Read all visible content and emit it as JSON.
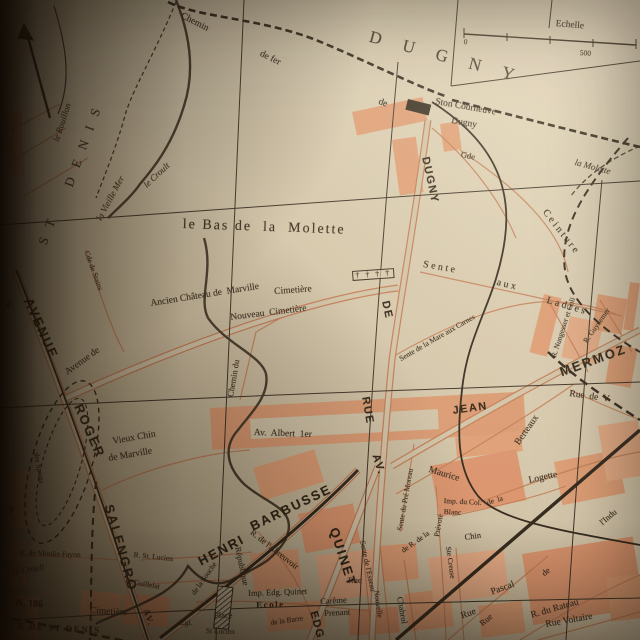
{
  "meta": {
    "kind": "vintage printed street map photographed in a book",
    "area": "Dugny / La Courneuve / St-Denis (northern Paris suburbs)"
  },
  "colors": {
    "paper_light": "#ece2ca",
    "paper_mid": "#d9cdb2",
    "paper_dark": "#b3a485",
    "building_fill": "#e7a47b",
    "road_line": "#c9805a",
    "ink": "#352b1f",
    "gutter_shadow": "#0a0603"
  },
  "scale": {
    "label": "Echelle",
    "start": "0",
    "end": "500"
  },
  "grid_refs": [
    "2",
    "3"
  ],
  "labels": [
    {
      "name": "railway-label-chemin",
      "text": "Chemin",
      "x": 183,
      "y": 12,
      "rot": 27,
      "cls": "s9"
    },
    {
      "name": "railway-label-de-fer",
      "text": "de fer",
      "x": 262,
      "y": 50,
      "rot": 26,
      "cls": "s9"
    },
    {
      "name": "railway-label-de",
      "text": "de",
      "x": 380,
      "y": 98,
      "rot": 20,
      "cls": "s9"
    },
    {
      "name": "commune-label-dugny",
      "text": "DUGNY",
      "x": 372,
      "y": 28,
      "rot": 15,
      "cls": "big"
    },
    {
      "name": "scale-label",
      "text": "Echelle",
      "x": 556,
      "y": 20,
      "rot": 5,
      "cls": "s9"
    },
    {
      "name": "scale-zero",
      "text": "0",
      "x": 464,
      "y": 38,
      "rot": 5,
      "cls": "ss"
    },
    {
      "name": "scale-500",
      "text": "500",
      "x": 580,
      "y": 49,
      "rot": 4,
      "cls": "ss"
    },
    {
      "name": "station-label-line1",
      "text": "Ston Courneuve",
      "x": 436,
      "y": 98,
      "rot": 10,
      "cls": "s9"
    },
    {
      "name": "station-label-line2",
      "text": "Dugny",
      "x": 452,
      "y": 117,
      "rot": 10,
      "cls": "s9"
    },
    {
      "name": "stream-label-la-molette",
      "text": "la Molette",
      "x": 576,
      "y": 158,
      "rot": 15,
      "cls": "it"
    },
    {
      "name": "railway-label-gde",
      "text": "Gde",
      "x": 462,
      "y": 150,
      "rot": 12,
      "cls": "s"
    },
    {
      "name": "railway-label-ceinture",
      "text": "Ceinture",
      "x": 548,
      "y": 208,
      "rot": 52,
      "cls": "sp"
    },
    {
      "name": "stream-label-le-rouillon",
      "text": "le Rouillon",
      "x": 52,
      "y": 140,
      "rot": -72,
      "cls": "it"
    },
    {
      "name": "stream-label-la-vieille-mer",
      "text": "la Vieille Mer",
      "x": 95,
      "y": 218,
      "rot": -62,
      "cls": "it"
    },
    {
      "name": "stream-label-le-croult-top",
      "text": "le Croult",
      "x": 142,
      "y": 183,
      "rot": -43,
      "cls": "it"
    },
    {
      "name": "commune-label-st",
      "text": "ST",
      "x": 36,
      "y": 242,
      "rot": -70,
      "cls": "big2"
    },
    {
      "name": "commune-label-denis",
      "text": "DENIS",
      "x": 62,
      "y": 184,
      "rot": -70,
      "cls": "big2"
    },
    {
      "name": "grid-number-2",
      "text": "2",
      "x": 6,
      "y": 300,
      "rot": 0,
      "cls": "num"
    },
    {
      "name": "grid-number-3",
      "text": "3",
      "x": 8,
      "y": 506,
      "rot": 0,
      "cls": "num"
    },
    {
      "name": "place-label-bas-de-la-molette",
      "text": "le Bas de  la  Molette",
      "x": 183,
      "y": 218,
      "rot": 2,
      "cls": "place"
    },
    {
      "name": "street-label-avenue-de",
      "text": "Avenue de",
      "x": 64,
      "y": 370,
      "rot": -36,
      "cls": "s9"
    },
    {
      "name": "street-label-ancien-chateau",
      "text": "Ancien Château de  Marville",
      "x": 150,
      "y": 300,
      "rot": -9,
      "cls": "s9"
    },
    {
      "name": "label-cimetiere",
      "text": "Cimetière",
      "x": 274,
      "y": 288,
      "rot": -4,
      "cls": "s9"
    },
    {
      "name": "cemetery-symbol",
      "text": "† † † †",
      "x": 352,
      "y": 271,
      "rot": -4,
      "cls": "cem"
    },
    {
      "name": "label-nouveau-cimetiere",
      "text": "Nouveau  Cimetière",
      "x": 230,
      "y": 314,
      "rot": -7,
      "cls": "s9"
    },
    {
      "name": "street-label-chemin-du",
      "text": "Chemin du",
      "x": 226,
      "y": 396,
      "rot": -80,
      "cls": "s"
    },
    {
      "name": "street-label-cde-de-stains",
      "text": "Cde de Stains",
      "x": 90,
      "y": 250,
      "rot": 70,
      "cls": "ss"
    },
    {
      "name": "street-label-sente",
      "text": "Sente",
      "x": 424,
      "y": 260,
      "rot": 10,
      "cls": "sp"
    },
    {
      "name": "street-label-aux",
      "text": "aux",
      "x": 498,
      "y": 278,
      "rot": 14,
      "cls": "sp"
    },
    {
      "name": "street-label-ladres",
      "text": "Ladres",
      "x": 548,
      "y": 296,
      "rot": 16,
      "cls": "sp"
    },
    {
      "name": "street-label-mare-aux-carnes",
      "text": "Sente de la Mare aux Carnes",
      "x": 398,
      "y": 356,
      "rot": -30,
      "cls": "ss"
    },
    {
      "name": "street-label-dugny-vertical",
      "text": "DUGNY",
      "x": 430,
      "y": 156,
      "rot": 78,
      "cls": "b"
    },
    {
      "name": "street-label-de-vertical",
      "text": "DE",
      "x": 390,
      "y": 300,
      "rot": 78,
      "cls": "b"
    },
    {
      "name": "street-label-rue-vertical",
      "text": "RUE",
      "x": 370,
      "y": 396,
      "rot": 80,
      "cls": "b"
    },
    {
      "name": "street-label-avenue",
      "text": "AVENUE",
      "x": 34,
      "y": 296,
      "rot": 66,
      "cls": "B"
    },
    {
      "name": "street-label-roger",
      "text": "ROGER",
      "x": 84,
      "y": 402,
      "rot": 66,
      "cls": "B"
    },
    {
      "name": "street-label-salengro",
      "text": "SALENGRO",
      "x": 115,
      "y": 503,
      "rot": 74,
      "cls": "B"
    },
    {
      "name": "street-label-vieux-chin",
      "text": "Vieux Chin",
      "x": 112,
      "y": 438,
      "rot": -10,
      "cls": "s9"
    },
    {
      "name": "street-label-de-marville",
      "text": "de Marville",
      "x": 108,
      "y": 455,
      "rot": -10,
      "cls": "s9"
    },
    {
      "name": "label-des-sports",
      "text": "des Sports",
      "x": 40,
      "y": 452,
      "rot": 80,
      "cls": "ss"
    },
    {
      "name": "street-label-av-albert-1er",
      "text": "Av.  Albert  1er",
      "x": 254,
      "y": 429,
      "rot": 2,
      "cls": "s9"
    },
    {
      "name": "street-label-henri",
      "text": "HENRI",
      "x": 196,
      "y": 556,
      "rot": -28,
      "cls": "B"
    },
    {
      "name": "street-label-barbusse",
      "text": "BARBUSSE",
      "x": 248,
      "y": 521,
      "rot": -26,
      "cls": "B"
    },
    {
      "name": "street-label-av-quinet",
      "text": "AV.",
      "x": 380,
      "y": 453,
      "rot": 72,
      "cls": "b"
    },
    {
      "name": "street-label-quinet",
      "text": "QUINET",
      "x": 340,
      "y": 526,
      "rot": 72,
      "cls": "B"
    },
    {
      "name": "street-label-edg",
      "text": "EDG.",
      "x": 318,
      "y": 610,
      "rot": 75,
      "cls": "b"
    },
    {
      "name": "street-label-jean",
      "text": "JEAN",
      "x": 452,
      "y": 406,
      "rot": -8,
      "cls": "b"
    },
    {
      "name": "street-label-mermoz",
      "text": "MERMOZ",
      "x": 558,
      "y": 366,
      "rot": -20,
      "cls": "B"
    },
    {
      "name": "street-label-berteaux",
      "text": "Berteaux",
      "x": 514,
      "y": 442,
      "rot": -55,
      "cls": "s9"
    },
    {
      "name": "street-label-maurice",
      "text": "Maurice",
      "x": 430,
      "y": 466,
      "rot": 17,
      "cls": "s9"
    },
    {
      "name": "street-label-pre-moreau",
      "text": "Sente du Pré Moreau",
      "x": 396,
      "y": 530,
      "rot": -80,
      "cls": "ss"
    },
    {
      "name": "street-label-rue-de-v",
      "text": "Rue  de  V",
      "x": 570,
      "y": 390,
      "rot": 8,
      "cls": "s9"
    },
    {
      "name": "street-label-nungesser",
      "text": "R. Nungesser et Coli",
      "x": 550,
      "y": 356,
      "rot": -72,
      "cls": "ss"
    },
    {
      "name": "street-label-guynemer",
      "text": "R. Guynemer",
      "x": 582,
      "y": 340,
      "rot": -55,
      "cls": "ss"
    },
    {
      "name": "street-label-republique",
      "text": "République",
      "x": 242,
      "y": 546,
      "rot": 78,
      "cls": "s"
    },
    {
      "name": "label-place",
      "text": "Place",
      "x": 214,
      "y": 611,
      "rot": 0,
      "cls": "s"
    },
    {
      "name": "label-st-lucien",
      "text": "St Lucien",
      "x": 206,
      "y": 627,
      "rot": 2,
      "cls": "ss"
    },
    {
      "name": "label-eglise",
      "text": "Égl.",
      "x": 180,
      "y": 619,
      "rot": 0,
      "cls": "ss"
    },
    {
      "name": "street-label-av-barbusse",
      "text": "AV.",
      "x": 150,
      "y": 608,
      "rot": 72,
      "cls": "sp2"
    },
    {
      "name": "label-cimetiere-sud",
      "text": "Cimetière",
      "x": 90,
      "y": 607,
      "rot": 3,
      "cls": "s9"
    },
    {
      "name": "street-label-rue-de-st-denis",
      "text": "RUE DE ST DENIS",
      "x": 2,
      "y": 621,
      "rot": 3,
      "cls": "sp2"
    },
    {
      "name": "route-number-n186",
      "text": "N. 186",
      "x": 16,
      "y": 599,
      "rot": 2,
      "cls": "num"
    },
    {
      "name": "stream-label-le-croult-bottom",
      "text": "le Croult",
      "x": 12,
      "y": 568,
      "rot": -10,
      "cls": "it"
    },
    {
      "name": "street-label-moulin-fayon",
      "text": "R. du Moulin Fayon",
      "x": 20,
      "y": 549,
      "rot": 2,
      "cls": "ss"
    },
    {
      "name": "street-label-r-st-lucien",
      "text": "R. St. Lucien",
      "x": 134,
      "y": 551,
      "rot": 6,
      "cls": "ss"
    },
    {
      "name": "street-label-guillelat",
      "text": "R. Guillelat",
      "x": 126,
      "y": 577,
      "rot": 10,
      "cls": "ss"
    },
    {
      "name": "street-label-de-la-souche",
      "text": "de la Souche",
      "x": 190,
      "y": 592,
      "rot": -55,
      "cls": "ss"
    },
    {
      "name": "street-label-imp-edg-quinet",
      "text": "Imp. Edg. Quinet",
      "x": 248,
      "y": 589,
      "rot": -2,
      "cls": "s"
    },
    {
      "name": "label-ecole",
      "text": "Ecole",
      "x": 256,
      "y": 601,
      "rot": -2,
      "cls": "sp2"
    },
    {
      "name": "street-label-de-la-barre",
      "text": "de la Barre",
      "x": 270,
      "y": 619,
      "rot": -8,
      "cls": "ss"
    },
    {
      "name": "street-label-careme",
      "text": "Carême",
      "x": 320,
      "y": 597,
      "rot": -3,
      "cls": "s"
    },
    {
      "name": "street-label-prenant",
      "text": "Prenant",
      "x": 324,
      "y": 609,
      "rot": -3,
      "cls": "s"
    },
    {
      "name": "street-label-abreuvoir",
      "text": "R. de l'Abreuvoir",
      "x": 254,
      "y": 528,
      "rot": 38,
      "cls": "s"
    },
    {
      "name": "street-label-rue-nouvelle-rue",
      "text": "Rue",
      "x": 348,
      "y": 576,
      "rot": 0,
      "cls": "s"
    },
    {
      "name": "street-label-nouvelle",
      "text": "Nouvelle",
      "x": 380,
      "y": 590,
      "rot": 82,
      "cls": "ss"
    },
    {
      "name": "street-label-esseau",
      "text": "Sente de l'Esseau",
      "x": 366,
      "y": 540,
      "rot": 78,
      "cls": "ss"
    },
    {
      "name": "street-label-r-de-la",
      "text": "de R. de la",
      "x": 400,
      "y": 548,
      "rot": -35,
      "cls": "ss"
    },
    {
      "name": "street-label-prevote",
      "text": "Prévoté",
      "x": 433,
      "y": 536,
      "rot": -80,
      "cls": "ss"
    },
    {
      "name": "street-label-imp-du-col",
      "text": "Imp. du Col.",
      "x": 444,
      "y": 497,
      "rot": 3,
      "cls": "ss"
    },
    {
      "name": "street-label-blanc",
      "text": "Blanc",
      "x": 444,
      "y": 508,
      "rot": 3,
      "cls": "ss"
    },
    {
      "name": "street-label-de-la-logette",
      "text": "de  la",
      "x": 486,
      "y": 499,
      "rot": -16,
      "cls": "ss"
    },
    {
      "name": "street-label-logette",
      "text": "Logette",
      "x": 528,
      "y": 477,
      "rot": -12,
      "cls": "s9"
    },
    {
      "name": "street-label-chin",
      "text": "Chin",
      "x": 464,
      "y": 533,
      "rot": -8,
      "cls": "s"
    },
    {
      "name": "street-label-ste-creuse",
      "text": "Ste Creuse",
      "x": 452,
      "y": 546,
      "rot": 82,
      "cls": "ss"
    },
    {
      "name": "street-label-chabrol",
      "text": "Chabrol",
      "x": 404,
      "y": 596,
      "rot": 80,
      "cls": "s"
    },
    {
      "name": "street-label-rue-pascal-rue",
      "text": "Rue",
      "x": 460,
      "y": 613,
      "rot": -20,
      "cls": "s9"
    },
    {
      "name": "street-label-pascal",
      "text": "Pascal",
      "x": 490,
      "y": 589,
      "rot": -20,
      "cls": "s9"
    },
    {
      "name": "street-label-industrie-rue",
      "text": "Rue",
      "x": 478,
      "y": 621,
      "rot": -40,
      "cls": "s"
    },
    {
      "name": "street-label-industrie-de",
      "text": "de",
      "x": 540,
      "y": 571,
      "rot": -40,
      "cls": "s"
    },
    {
      "name": "street-label-industrie",
      "text": "l'Indu",
      "x": 598,
      "y": 520,
      "rot": -40,
      "cls": "s"
    },
    {
      "name": "street-label-rateau",
      "text": "R. du Rateau",
      "x": 530,
      "y": 612,
      "rot": -16,
      "cls": "s9"
    },
    {
      "name": "street-label-voltaire",
      "text": "Rue Voltaire",
      "x": 545,
      "y": 621,
      "rot": -10,
      "cls": "s9"
    }
  ]
}
